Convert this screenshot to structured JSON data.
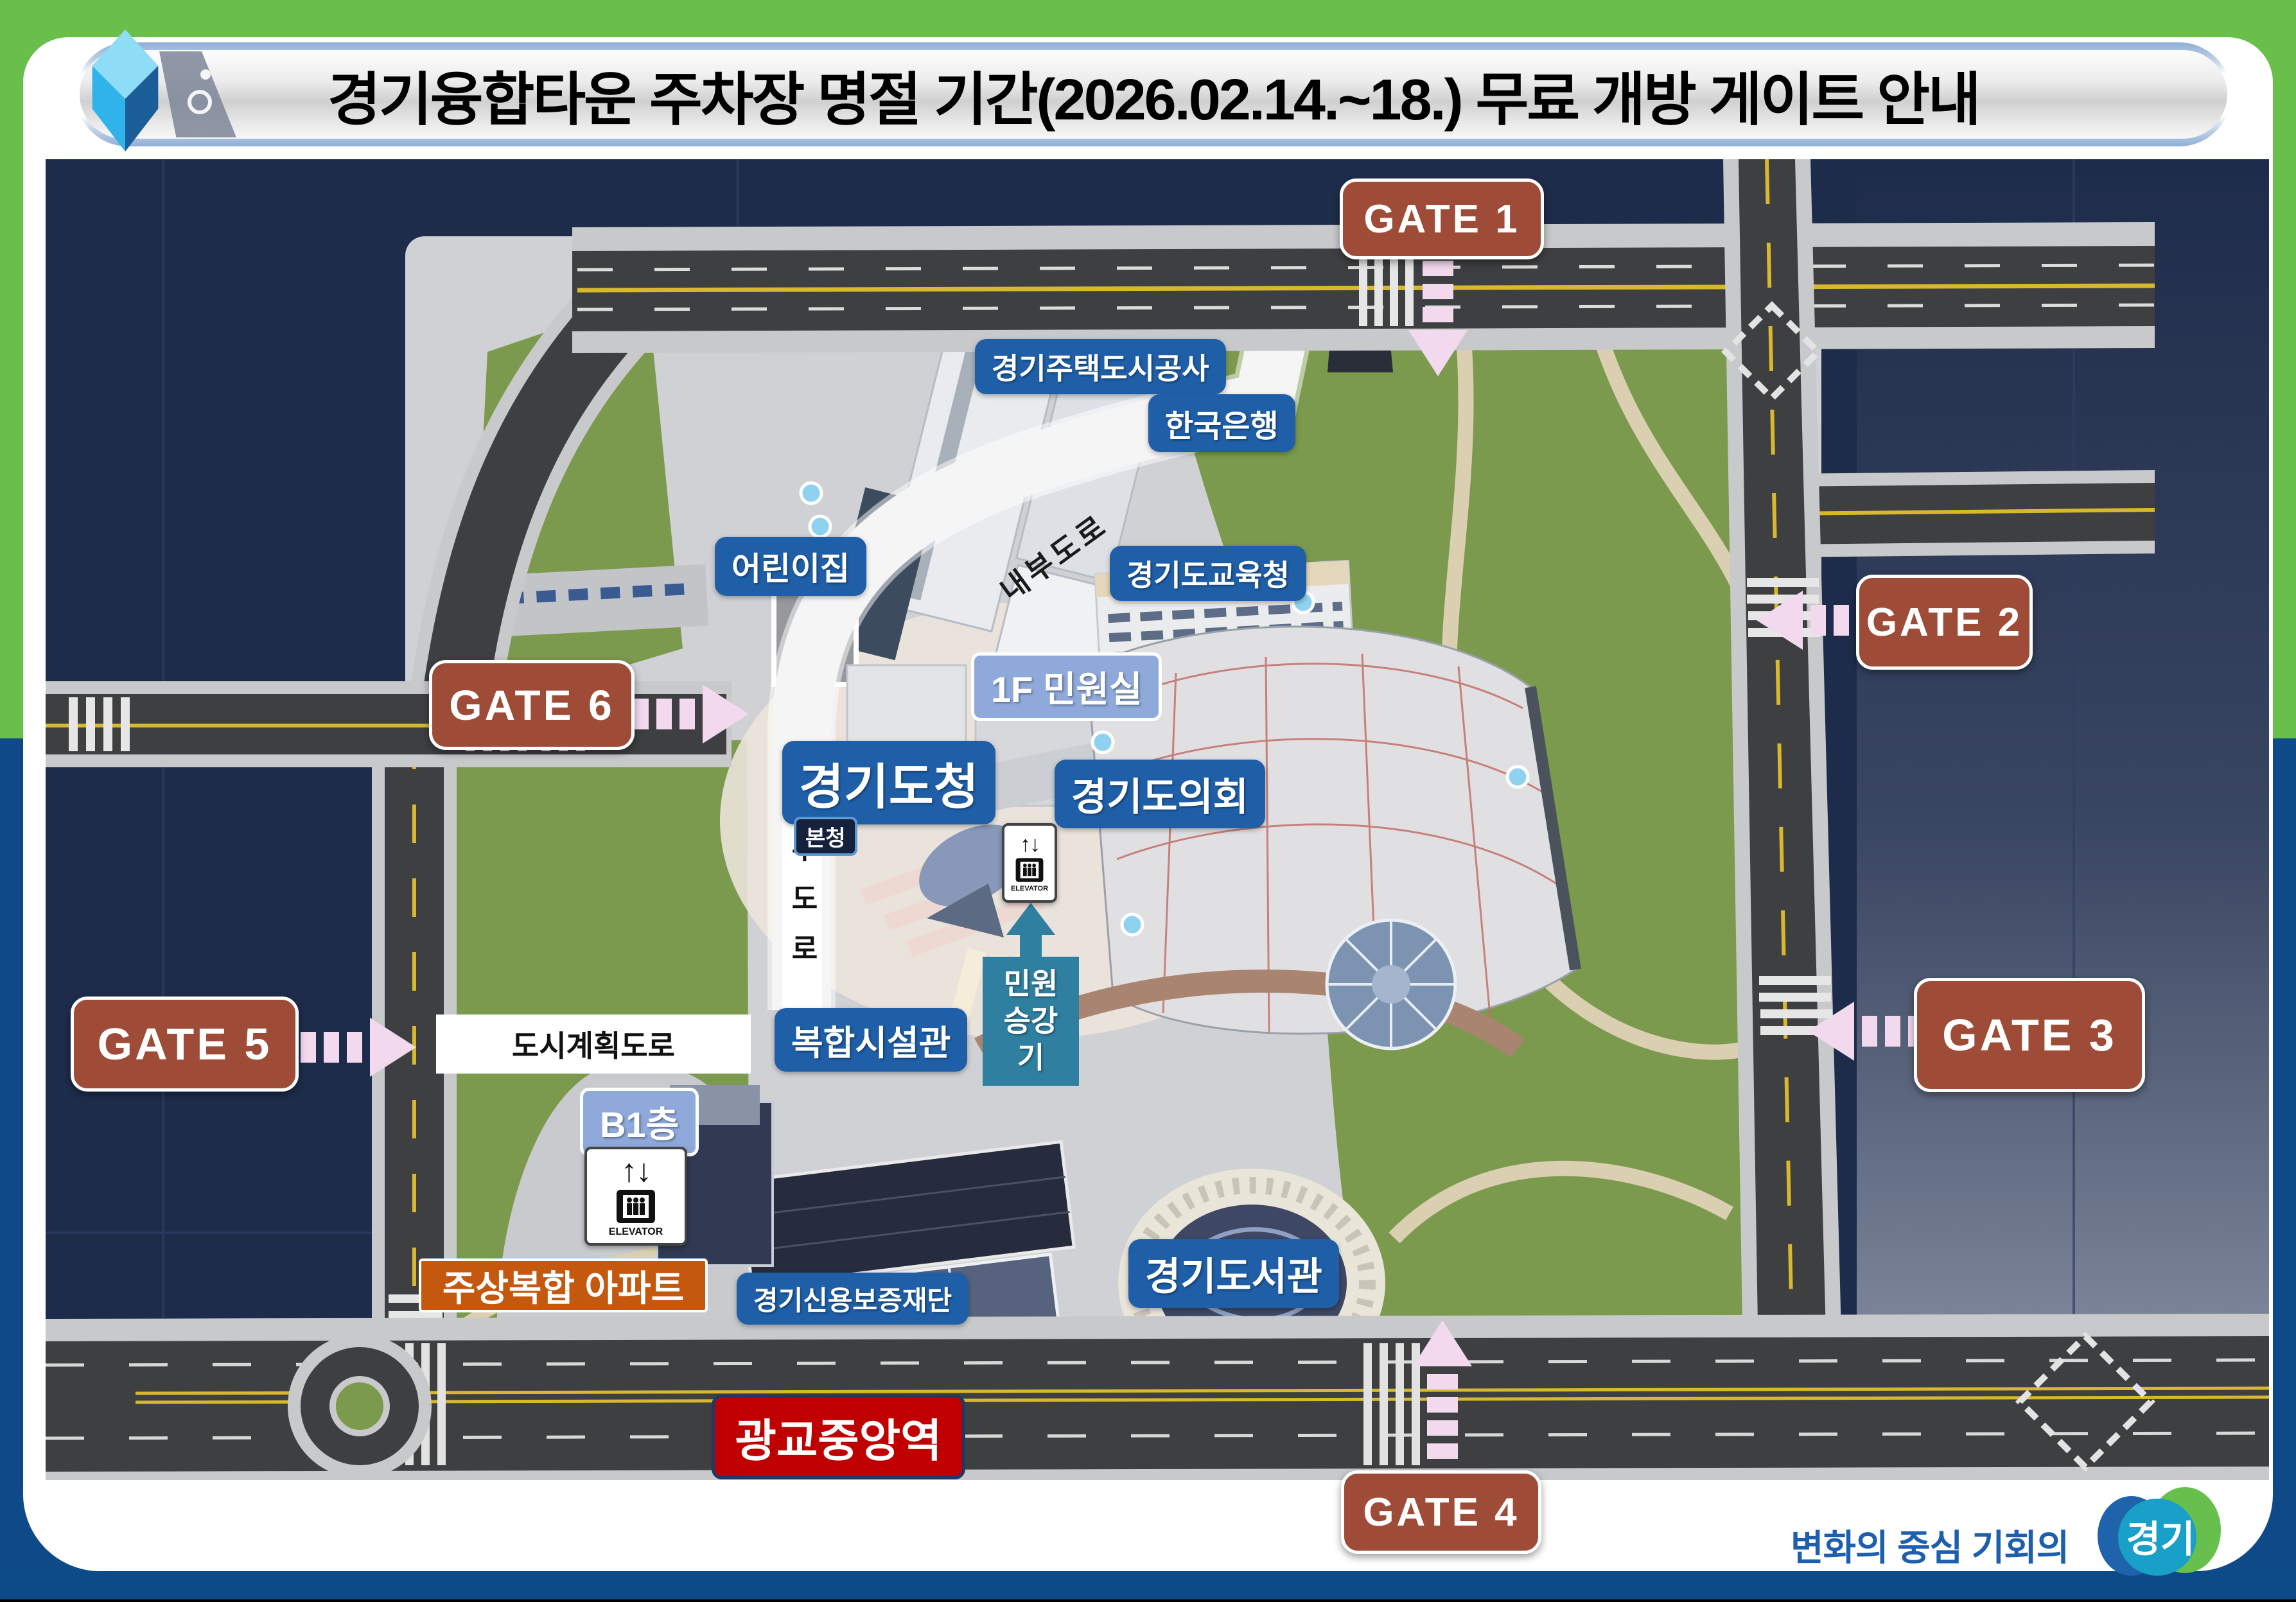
{
  "title": "경기융합타운 주차장 명절 기간(2026.02.14.~18.) 무료 개방 게이트 안내",
  "gates": {
    "gate1": "GATE 1",
    "gate2": "GATE 2",
    "gate3": "GATE 3",
    "gate4": "GATE 4",
    "gate5": "GATE 5",
    "gate6": "GATE 6"
  },
  "labels": {
    "housing_corp": "경기주택도시공사",
    "bank_of_korea": "한국은행",
    "daycare": "어린이집",
    "education_office": "경기도교육청",
    "civil_office_1f": "1F 민원실",
    "provincial_hall": "경기도청",
    "provincial_assembly": "경기도의회",
    "main_building": "본청",
    "civil_elevator_line1": "민원",
    "civil_elevator_line2": "승강기",
    "complex_facility": "복합시설관",
    "b1_floor": "B1층",
    "apartment": "주상복합 아파트",
    "credit_foundation": "경기신용보증재단",
    "gwanggyo_station": "광교중앙역",
    "library": "경기도서관"
  },
  "roads": {
    "inner_road_curved": "내부도로",
    "inner_road_vertical": "내부도로",
    "city_planning_road": "도시계획도로"
  },
  "icons": {
    "elevator_arrows": "↑↓",
    "elevator_label": "ELEVATOR"
  },
  "footer": {
    "slogan": "변화의 중심 기회의",
    "logo": "경기"
  },
  "colors": {
    "frame_green": "#6abf4b",
    "frame_blue": "#0e4a87",
    "map_navy": "#1e2c4b",
    "gate_brown": "#9e4c37",
    "label_blue": "#1f5fa8",
    "label_light_blue": "#8ea9da",
    "label_teal": "#2e7fa0",
    "station_red": "#c00000",
    "apartment_orange": "#c4580f",
    "arrow_pink": "#f2d9ee",
    "park_green": "#7b9a4d",
    "road_gray": "#3e3f41"
  }
}
